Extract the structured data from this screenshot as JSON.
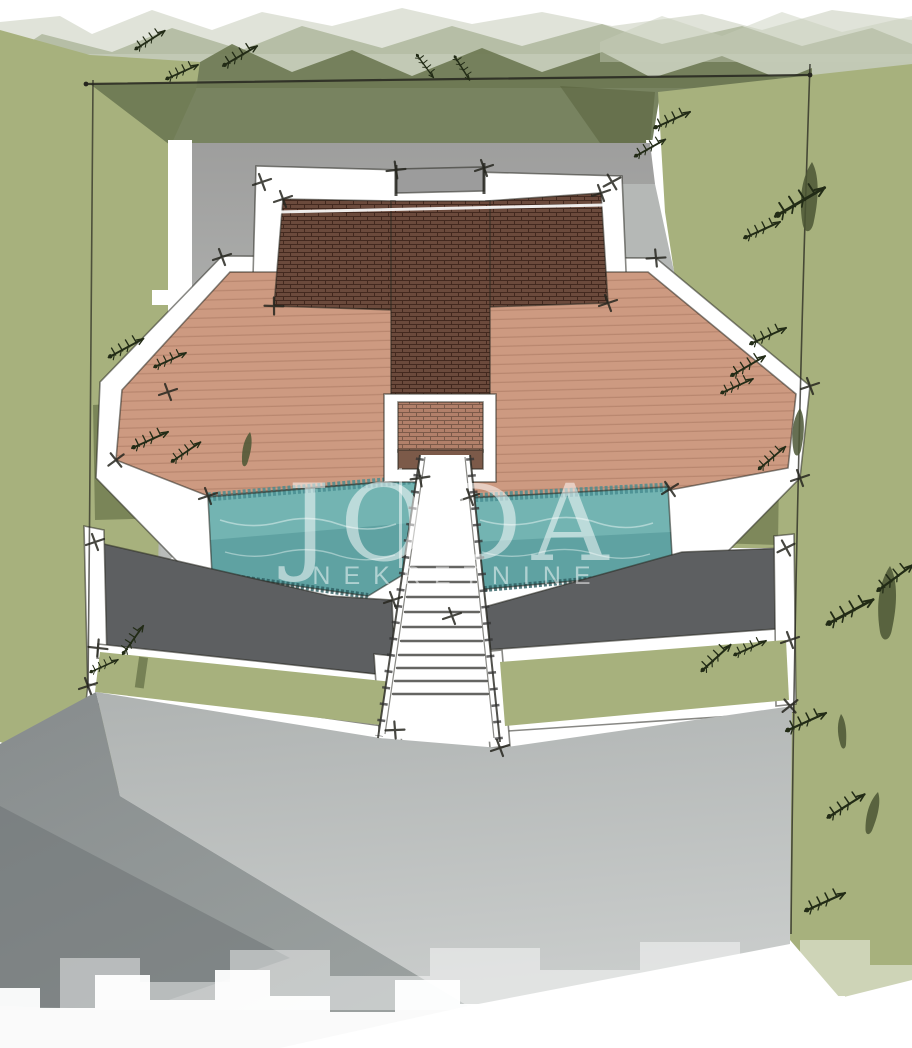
{
  "document": {
    "type_label": "Architectural site plan watercolor sketch"
  },
  "watermark": {
    "line1": "JODA",
    "line2": "NEKRETNINE"
  },
  "icons": {
    "plant": "twig-sketch",
    "tree": "cypress-silhouette"
  },
  "colors": {
    "paper": "#ffffff",
    "washLight": "#c6ccb9",
    "washMid": "#9aa584",
    "washDark": "#6d7852",
    "grass": "#a7b17d",
    "grassDeep": "#8e9c68",
    "oliveShadow": "#55603a",
    "concrete": "#9e9e9d",
    "concreteLight": "#b3b5b3",
    "pathGray": "#b5b8b6",
    "driveway": "#afb3b2",
    "drivewayLight": "#c9cccb",
    "road": "#878c8d",
    "roadShadow": "#6e7374",
    "terrace": "#5d5f61",
    "deckBase": "#cd9a81",
    "deckLine": "#b5846c",
    "roofDark": "#6b4a3c",
    "roofGrid": "#43291f",
    "roofLight": "#b2806a",
    "roofBand": "#7c5a49",
    "ridge": "#9c9c9c",
    "poolBase": "#73b4b2",
    "poolDeep": "#468b8e",
    "poolEdge": "#2c5d60",
    "sketch": "#26261f",
    "twig": "#222b16",
    "cypress": "#4b5634",
    "watermark": "#ffffff"
  }
}
